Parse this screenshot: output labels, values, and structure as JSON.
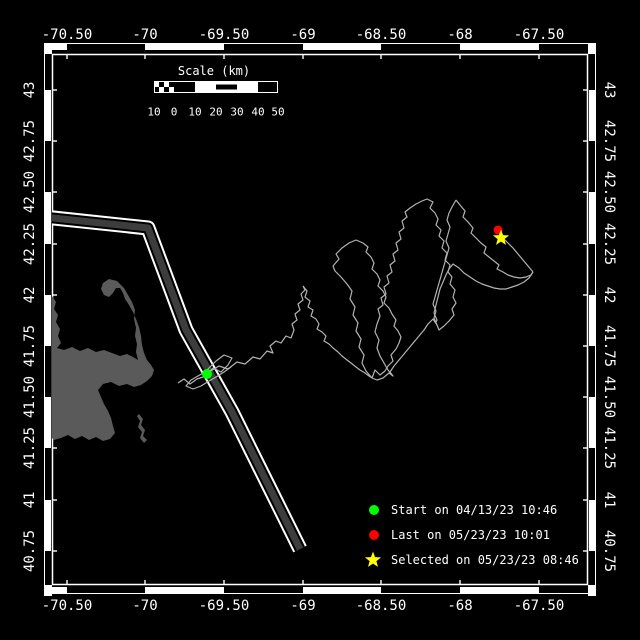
{
  "window": {
    "width": 640,
    "height": 640,
    "bg": "#000000"
  },
  "axes": {
    "lon_ticks": [
      {
        "label": "-70.50",
        "x": 67
      },
      {
        "label": "-70",
        "x": 145
      },
      {
        "label": "-69.50",
        "x": 224
      },
      {
        "label": "-69",
        "x": 303
      },
      {
        "label": "-68.50",
        "x": 381
      },
      {
        "label": "-68",
        "x": 460
      },
      {
        "label": "-67.50",
        "x": 539
      }
    ],
    "lat_ticks": [
      {
        "label": "43",
        "y": 90
      },
      {
        "label": "42.75",
        "y": 141
      },
      {
        "label": "42.50",
        "y": 192
      },
      {
        "label": "42.25",
        "y": 244
      },
      {
        "label": "42",
        "y": 295
      },
      {
        "label": "41.75",
        "y": 346
      },
      {
        "label": "41.50",
        "y": 397
      },
      {
        "label": "41.25",
        "y": 448
      },
      {
        "label": "41",
        "y": 500
      },
      {
        "label": "40.75",
        "y": 551
      }
    ],
    "top_label_y": 35,
    "bottom_label_y": 606,
    "left_label_x": 30,
    "right_label_x": 609
  },
  "frame": {
    "outer": {
      "x1": 44,
      "y1": 43,
      "x2": 596,
      "y2": 594
    },
    "inner": {
      "x1": 52,
      "y1": 54,
      "x2": 588,
      "y2": 585
    },
    "band": 6,
    "line_color": "#ffffff"
  },
  "scalebar": {
    "title": "Scale (km)",
    "labels": [
      "10",
      "0",
      "10",
      "20",
      "30",
      "40",
      "50"
    ],
    "tick_x": [
      154,
      174,
      195,
      216,
      237,
      258,
      278
    ],
    "bar_y": 81,
    "bar_h": 12,
    "title_x": 214,
    "title_y": 71,
    "labels_y": 112,
    "segments": [
      "checker",
      "black",
      "white",
      "stripe",
      "white",
      "black"
    ]
  },
  "legend": {
    "marker_x": 374,
    "text_x": 391,
    "items": [
      {
        "marker": "circle",
        "color": "#00ff00",
        "label": "Start on 04/13/23 10:46",
        "y": 510
      },
      {
        "marker": "circle",
        "color": "#ff0000",
        "label": "Last on 05/23/23 10:01",
        "y": 535
      },
      {
        "marker": "star",
        "color": "#ffff00",
        "label": "Selected on 05/23/23 08:46",
        "y": 560
      }
    ]
  },
  "map": {
    "land_color": "#5a5a5a",
    "land_paths": [
      "M52,296 L56,302 54,309 58,315 56,322 60,329 58,336 61,343 57,348 64,350 72,347 80,351 88,348 96,352 104,350 112,353 120,356 127,354 133,357 138,360 136,352 137,344 135,336 136,328 134,319 135,310 132,302 128,295 124,288 117,281 109,279 103,283 101,289 104,295 109,297 113,293 116,288 120,288 123,293 125,299 129,305 133,312 136,319 139,327 141,336 142,345 144,353 147,360 151,365 154,370 152,376 147,381 141,385 134,387 127,384 119,386 111,382 103,384 98,390 101,397 104,404 108,411 111,418 113,426 115,433 110,439 103,441 96,437 89,440 82,436 75,439 68,435 61,438 54,440 52,438 Z",
      "M139,414 L143,419 141,425 145,430 143,436 147,440 144,443 140,438 142,432 138,427 140,421 137,416 Z"
    ],
    "lane": {
      "centerline": [
        [
          44,
          217
        ],
        [
          148,
          228
        ],
        [
          186,
          330
        ],
        [
          232,
          412
        ],
        [
          300,
          549
        ]
      ],
      "outer_color": "#ffffff",
      "gap_color": "#000000",
      "core_color": "#3d3d3d",
      "outer_w": 15,
      "gap_w": 11,
      "core_w": 7
    },
    "track": {
      "color": "#b3b3b3",
      "width": 1.2,
      "segments": [
        [
          [
            178,
            383
          ],
          [
            184,
            379
          ],
          [
            190,
            384
          ],
          [
            197,
            379
          ],
          [
            203,
            377
          ],
          [
            207,
            374
          ]
        ],
        [
          [
            207,
            374
          ],
          [
            213,
            368
          ],
          [
            221,
            372
          ],
          [
            228,
            365
          ],
          [
            232,
            358
          ],
          [
            224,
            355
          ],
          [
            216,
            361
          ],
          [
            210,
            367
          ],
          [
            205,
            372
          ],
          [
            198,
            376
          ],
          [
            191,
            380
          ],
          [
            186,
            386
          ],
          [
            193,
            389
          ],
          [
            201,
            386
          ],
          [
            209,
            381
          ],
          [
            216,
            377
          ],
          [
            224,
            372
          ],
          [
            231,
            367
          ]
        ],
        [
          [
            209,
            372
          ],
          [
            219,
            366
          ],
          [
            228,
            369
          ],
          [
            237,
            362
          ],
          [
            245,
            364
          ],
          [
            253,
            357
          ],
          [
            260,
            359
          ],
          [
            267,
            351
          ],
          [
            273,
            353
          ],
          [
            270,
            346
          ],
          [
            276,
            341
          ],
          [
            281,
            343
          ],
          [
            286,
            336
          ],
          [
            291,
            338
          ],
          [
            294,
            330
          ],
          [
            292,
            324
          ],
          [
            297,
            320
          ],
          [
            295,
            314
          ],
          [
            300,
            310
          ],
          [
            298,
            304
          ],
          [
            303,
            300
          ],
          [
            301,
            294
          ],
          [
            305,
            290
          ],
          [
            303,
            286
          ]
        ],
        [
          [
            303,
            286
          ],
          [
            307,
            291
          ],
          [
            305,
            297
          ],
          [
            310,
            301
          ],
          [
            308,
            307
          ],
          [
            313,
            310
          ],
          [
            311,
            316
          ],
          [
            316,
            319
          ],
          [
            319,
            324
          ],
          [
            317,
            329
          ],
          [
            322,
            332
          ],
          [
            326,
            336
          ],
          [
            324,
            341
          ],
          [
            329,
            344
          ],
          [
            333,
            348
          ],
          [
            338,
            352
          ],
          [
            342,
            356
          ],
          [
            347,
            360
          ],
          [
            351,
            363
          ],
          [
            356,
            367
          ],
          [
            360,
            370
          ],
          [
            365,
            373
          ],
          [
            369,
            376
          ],
          [
            372,
            378
          ]
        ],
        [
          [
            372,
            378
          ],
          [
            366,
            371
          ],
          [
            362,
            363
          ],
          [
            364,
            355
          ],
          [
            359,
            347
          ],
          [
            361,
            339
          ],
          [
            356,
            331
          ],
          [
            358,
            323
          ],
          [
            353,
            315
          ],
          [
            355,
            307
          ],
          [
            350,
            299
          ],
          [
            352,
            291
          ],
          [
            347,
            284
          ],
          [
            341,
            277
          ],
          [
            335,
            271
          ],
          [
            333,
            266
          ],
          [
            339,
            259
          ],
          [
            336,
            254
          ],
          [
            342,
            248
          ],
          [
            349,
            243
          ],
          [
            356,
            240
          ],
          [
            363,
            243
          ],
          [
            368,
            247
          ],
          [
            366,
            252
          ],
          [
            371,
            257
          ],
          [
            374,
            263
          ],
          [
            372,
            269
          ],
          [
            377,
            274
          ],
          [
            380,
            280
          ],
          [
            378,
            286
          ],
          [
            383,
            291
          ],
          [
            386,
            297
          ],
          [
            384,
            303
          ],
          [
            389,
            308
          ],
          [
            392,
            314
          ],
          [
            396,
            320
          ],
          [
            394,
            326
          ],
          [
            398,
            331
          ],
          [
            401,
            337
          ],
          [
            399,
            343
          ],
          [
            396,
            349
          ],
          [
            391,
            355
          ],
          [
            393,
            361
          ],
          [
            388,
            366
          ],
          [
            385,
            371
          ],
          [
            380,
            375
          ],
          [
            375,
            370
          ],
          [
            372,
            378
          ]
        ],
        [
          [
            372,
            378
          ],
          [
            377,
            380
          ],
          [
            383,
            378
          ],
          [
            389,
            373
          ],
          [
            393,
            376
          ],
          [
            388,
            370
          ],
          [
            384,
            363
          ],
          [
            380,
            356
          ],
          [
            377,
            348
          ],
          [
            379,
            340
          ],
          [
            375,
            332
          ],
          [
            377,
            324
          ],
          [
            380,
            316
          ],
          [
            378,
            309
          ],
          [
            383,
            305
          ],
          [
            381,
            298
          ],
          [
            386,
            294
          ],
          [
            384,
            287
          ],
          [
            389,
            283
          ],
          [
            387,
            276
          ],
          [
            392,
            272
          ],
          [
            390,
            265
          ],
          [
            395,
            261
          ],
          [
            393,
            254
          ],
          [
            398,
            250
          ],
          [
            396,
            243
          ],
          [
            401,
            239
          ],
          [
            399,
            232
          ],
          [
            404,
            228
          ],
          [
            402,
            221
          ],
          [
            407,
            217
          ],
          [
            405,
            212
          ],
          [
            410,
            208
          ],
          [
            416,
            204
          ],
          [
            422,
            201
          ],
          [
            427,
            199
          ],
          [
            433,
            202
          ],
          [
            430,
            208
          ],
          [
            435,
            213
          ],
          [
            438,
            219
          ],
          [
            436,
            225
          ],
          [
            441,
            230
          ],
          [
            439,
            236
          ],
          [
            444,
            241
          ],
          [
            442,
            248
          ],
          [
            447,
            253
          ],
          [
            445,
            260
          ],
          [
            450,
            265
          ],
          [
            448,
            272
          ],
          [
            452,
            277
          ],
          [
            450,
            284
          ],
          [
            455,
            290
          ],
          [
            453,
            297
          ],
          [
            456,
            303
          ],
          [
            452,
            309
          ],
          [
            454,
            315
          ],
          [
            449,
            321
          ],
          [
            444,
            326
          ],
          [
            439,
            330
          ],
          [
            437,
            325
          ],
          [
            433,
            319
          ],
          [
            428,
            324
          ],
          [
            424,
            330
          ],
          [
            419,
            336
          ],
          [
            414,
            342
          ],
          [
            409,
            348
          ],
          [
            404,
            354
          ],
          [
            399,
            360
          ],
          [
            394,
            366
          ],
          [
            390,
            372
          ],
          [
            393,
            376
          ]
        ],
        [
          [
            437,
            325
          ],
          [
            434,
            318
          ],
          [
            436,
            311
          ],
          [
            433,
            304
          ],
          [
            435,
            297
          ],
          [
            437,
            290
          ],
          [
            439,
            283
          ],
          [
            441,
            276
          ],
          [
            443,
            269
          ],
          [
            445,
            262
          ],
          [
            447,
            255
          ],
          [
            449,
            248
          ],
          [
            446,
            241
          ],
          [
            448,
            234
          ],
          [
            450,
            227
          ],
          [
            447,
            220
          ],
          [
            449,
            213
          ],
          [
            452,
            207
          ],
          [
            456,
            200
          ]
        ],
        [
          [
            456,
            200
          ],
          [
            460,
            205
          ],
          [
            465,
            211
          ],
          [
            463,
            217
          ],
          [
            468,
            222
          ],
          [
            473,
            228
          ],
          [
            471,
            233
          ],
          [
            476,
            238
          ],
          [
            481,
            243
          ],
          [
            486,
            247
          ],
          [
            484,
            253
          ],
          [
            489,
            257
          ],
          [
            494,
            261
          ],
          [
            499,
            265
          ],
          [
            497,
            269
          ],
          [
            503,
            272
          ],
          [
            508,
            275
          ],
          [
            514,
            277
          ],
          [
            520,
            278
          ],
          [
            526,
            277
          ],
          [
            531,
            275
          ],
          [
            533,
            272
          ]
        ],
        [
          [
            533,
            272
          ],
          [
            529,
            278
          ],
          [
            524,
            282
          ],
          [
            518,
            285
          ],
          [
            512,
            287
          ],
          [
            506,
            289
          ],
          [
            500,
            289
          ],
          [
            494,
            288
          ],
          [
            488,
            286
          ],
          [
            482,
            284
          ],
          [
            476,
            281
          ],
          [
            470,
            277
          ],
          [
            464,
            273
          ],
          [
            459,
            268
          ],
          [
            453,
            264
          ],
          [
            449,
            269
          ],
          [
            446,
            275
          ],
          [
            443,
            282
          ],
          [
            440,
            289
          ],
          [
            438,
            297
          ],
          [
            436,
            305
          ],
          [
            434,
            313
          ],
          [
            437,
            320
          ],
          [
            436,
            322
          ]
        ],
        [
          [
            533,
            272
          ],
          [
            528,
            266
          ],
          [
            523,
            260
          ],
          [
            518,
            254
          ],
          [
            513,
            248
          ],
          [
            508,
            243
          ],
          [
            504,
            239
          ],
          [
            501,
            236
          ]
        ]
      ]
    },
    "markers": {
      "start": {
        "x": 207,
        "y": 374,
        "r": 5,
        "color": "#00ff00"
      },
      "last": {
        "x": 498,
        "y": 230,
        "r": 4.5,
        "color": "#ff0000"
      },
      "selected": {
        "x": 501,
        "y": 238,
        "r": 8.5,
        "color": "#ffff00"
      }
    }
  }
}
